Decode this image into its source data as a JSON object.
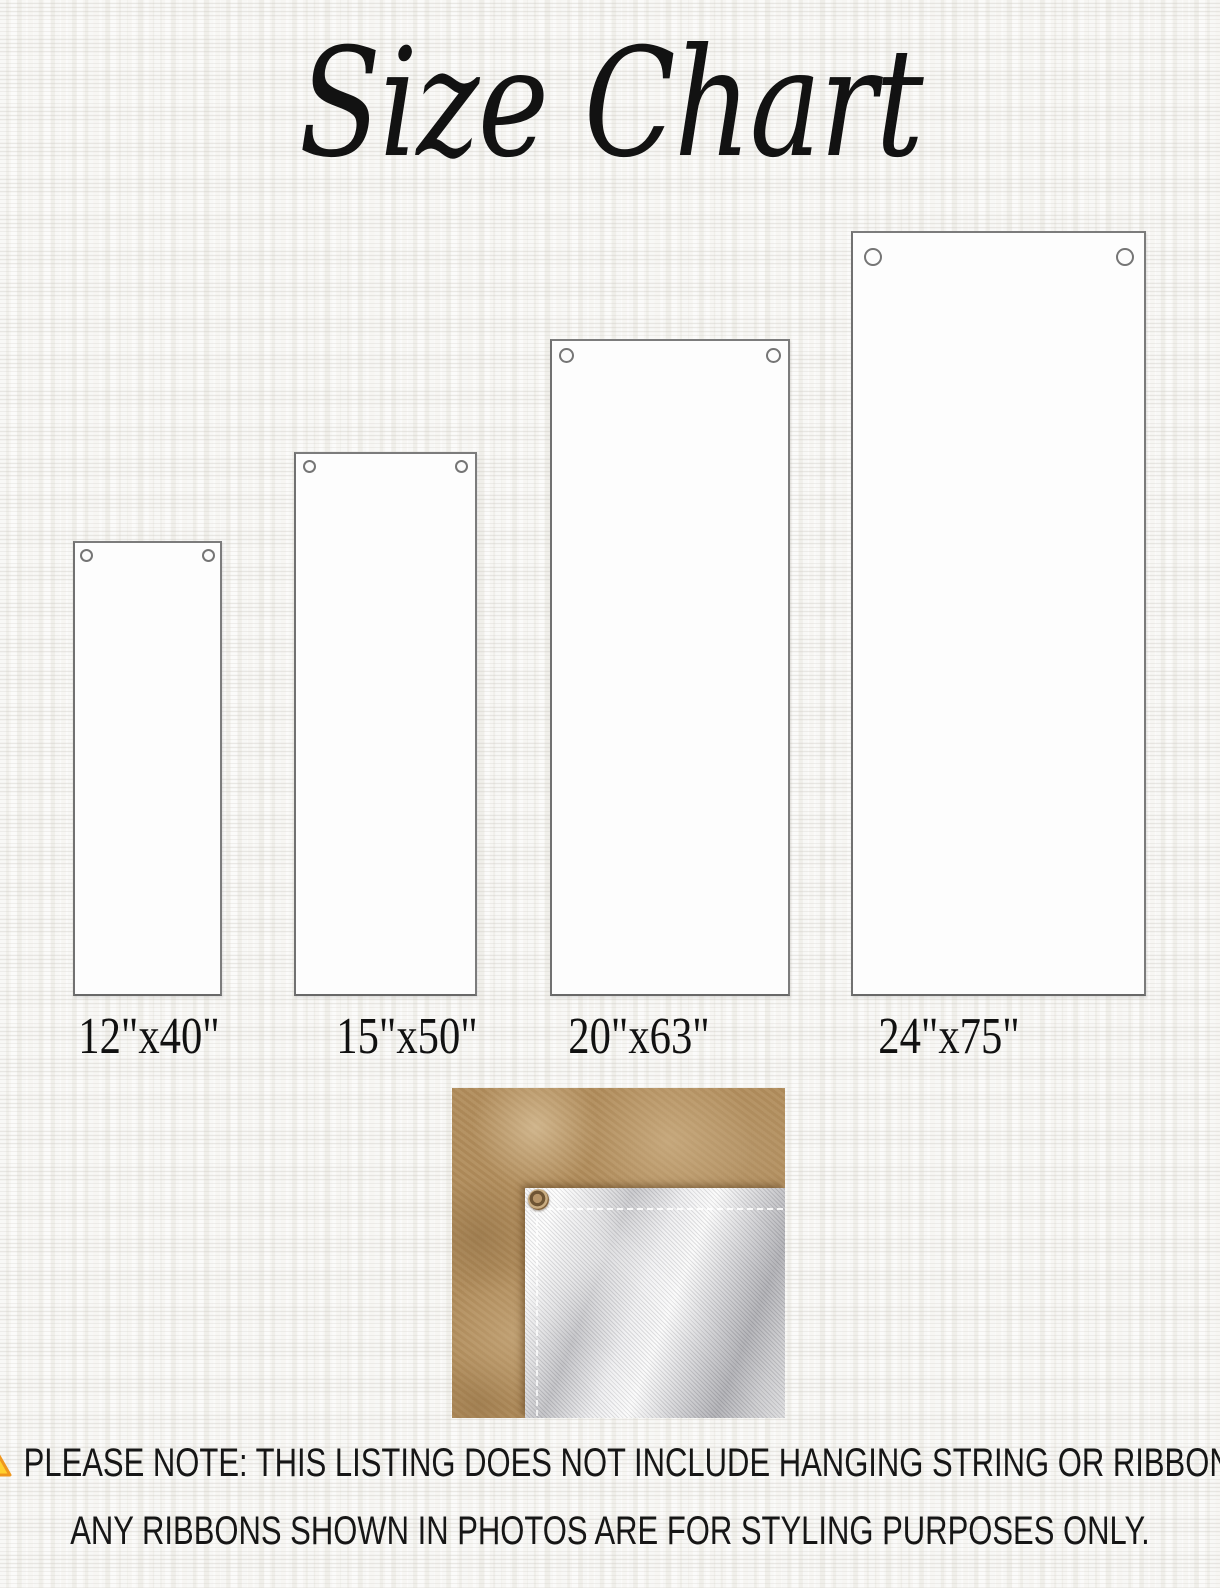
{
  "title": "Size Chart",
  "sizes": [
    {
      "label": "12\"x40\"",
      "width_inches": 12,
      "height_inches": 40
    },
    {
      "label": "15\"x50\"",
      "width_inches": 15,
      "height_inches": 50
    },
    {
      "label": "20\"x63\"",
      "width_inches": 20,
      "height_inches": 63
    },
    {
      "label": "24\"x75\"",
      "width_inches": 24,
      "height_inches": 75
    }
  ],
  "note": {
    "line1": "PLEASE NOTE: THIS LISTING DOES NOT INCLUDE HANGING STRING OR RIBBON.",
    "line2": "ANY RIBBONS SHOWN IN PHOTOS ARE FOR STYLING PURPOSES ONLY."
  },
  "icons": {
    "warning": "warning-triangle-icon",
    "grommet": "grommet-icon"
  },
  "colors": {
    "background": "#f7f6f3",
    "banner_fill": "#fdfdfd",
    "banner_border": "#7c7c7c",
    "title_text": "#121212",
    "note_text": "#161616",
    "warning_fill": "#ffd02e",
    "warning_border": "#f0971d",
    "warning_mark": "#e2641b",
    "photo_tan": "#b18d5c",
    "fabric_white": "#e9e9ea",
    "brass_grommet": "#84643e"
  }
}
